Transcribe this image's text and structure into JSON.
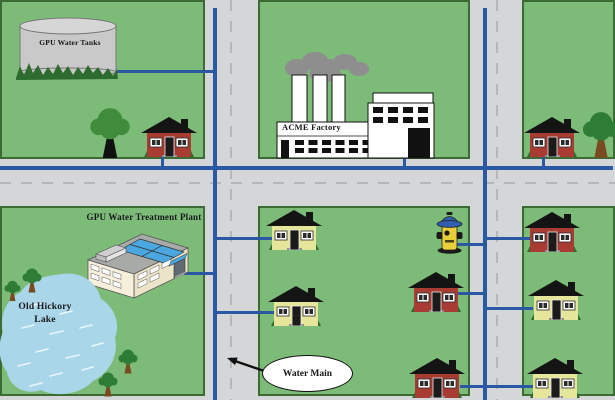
{
  "labels": {
    "water_tanks": "GPU Water Tanks",
    "factory": "ACME Factory",
    "treatment_plant": "GPU Water Treatment Plant",
    "lake": "Old Hickory Lake",
    "water_main": "Water Main"
  },
  "colors": {
    "grass": "#7cbc78",
    "block_border": "#3c6b36",
    "road": "#d5d6d8",
    "road_dash": "#b5b7b9",
    "pipe": "#2b58a3",
    "lake": "#a9d6e8",
    "lake_mark": "#eaf7fc",
    "house_red": "#a93c32",
    "house_yellow": "#e6e69a",
    "roof": "#141414",
    "tank_gray": "#c9c9c9",
    "tank_top": "#d6d6d6",
    "smoke": "#8e8e8e",
    "tree_green": "#418c3c",
    "tree_dark": "#2e7c35",
    "trunk_brown": "#7a4a21",
    "trunk_black": "#101010",
    "plant_cream": "#ece4c8",
    "plant_cream_light": "#f6efdb",
    "plant_roof": "#a8aaa8",
    "panel_blue": "#4aa7e0",
    "hydrant_yellow": "#e8cf3a",
    "hydrant_blue": "#2f5fae",
    "grass_tuft": "#2e6b2e",
    "ink": "#17171c"
  }
}
